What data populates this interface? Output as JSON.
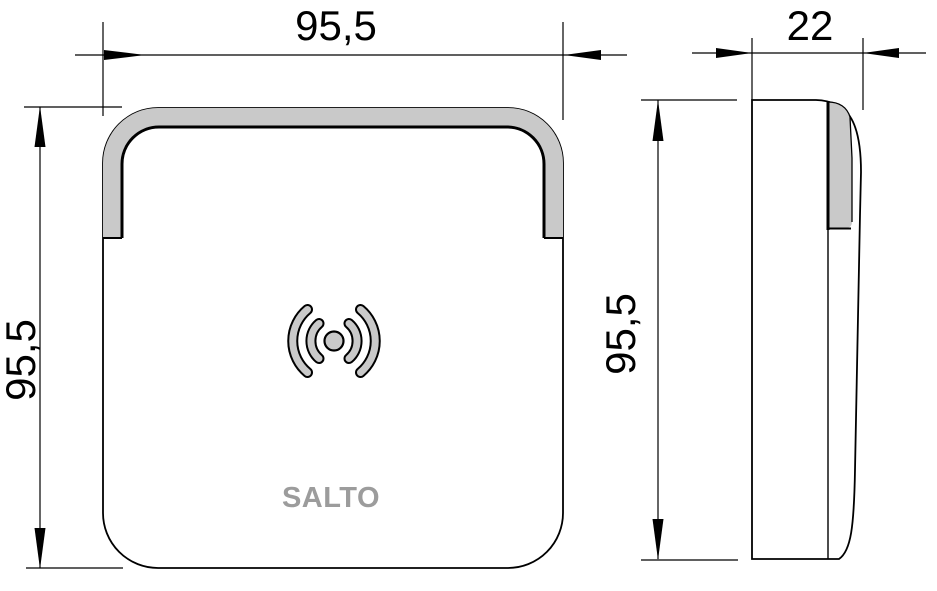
{
  "labels": {
    "front_width": "95,5",
    "front_height": "95,5",
    "side_depth": "22",
    "side_height": "95,5"
  },
  "logo": {
    "text": "SALTO",
    "color": "#9c9c9c"
  },
  "icons": {
    "antenna": "rfid-wave-icon"
  },
  "colors": {
    "band_gray": "#c9c9c9",
    "line": "#000000",
    "background": "#ffffff"
  }
}
